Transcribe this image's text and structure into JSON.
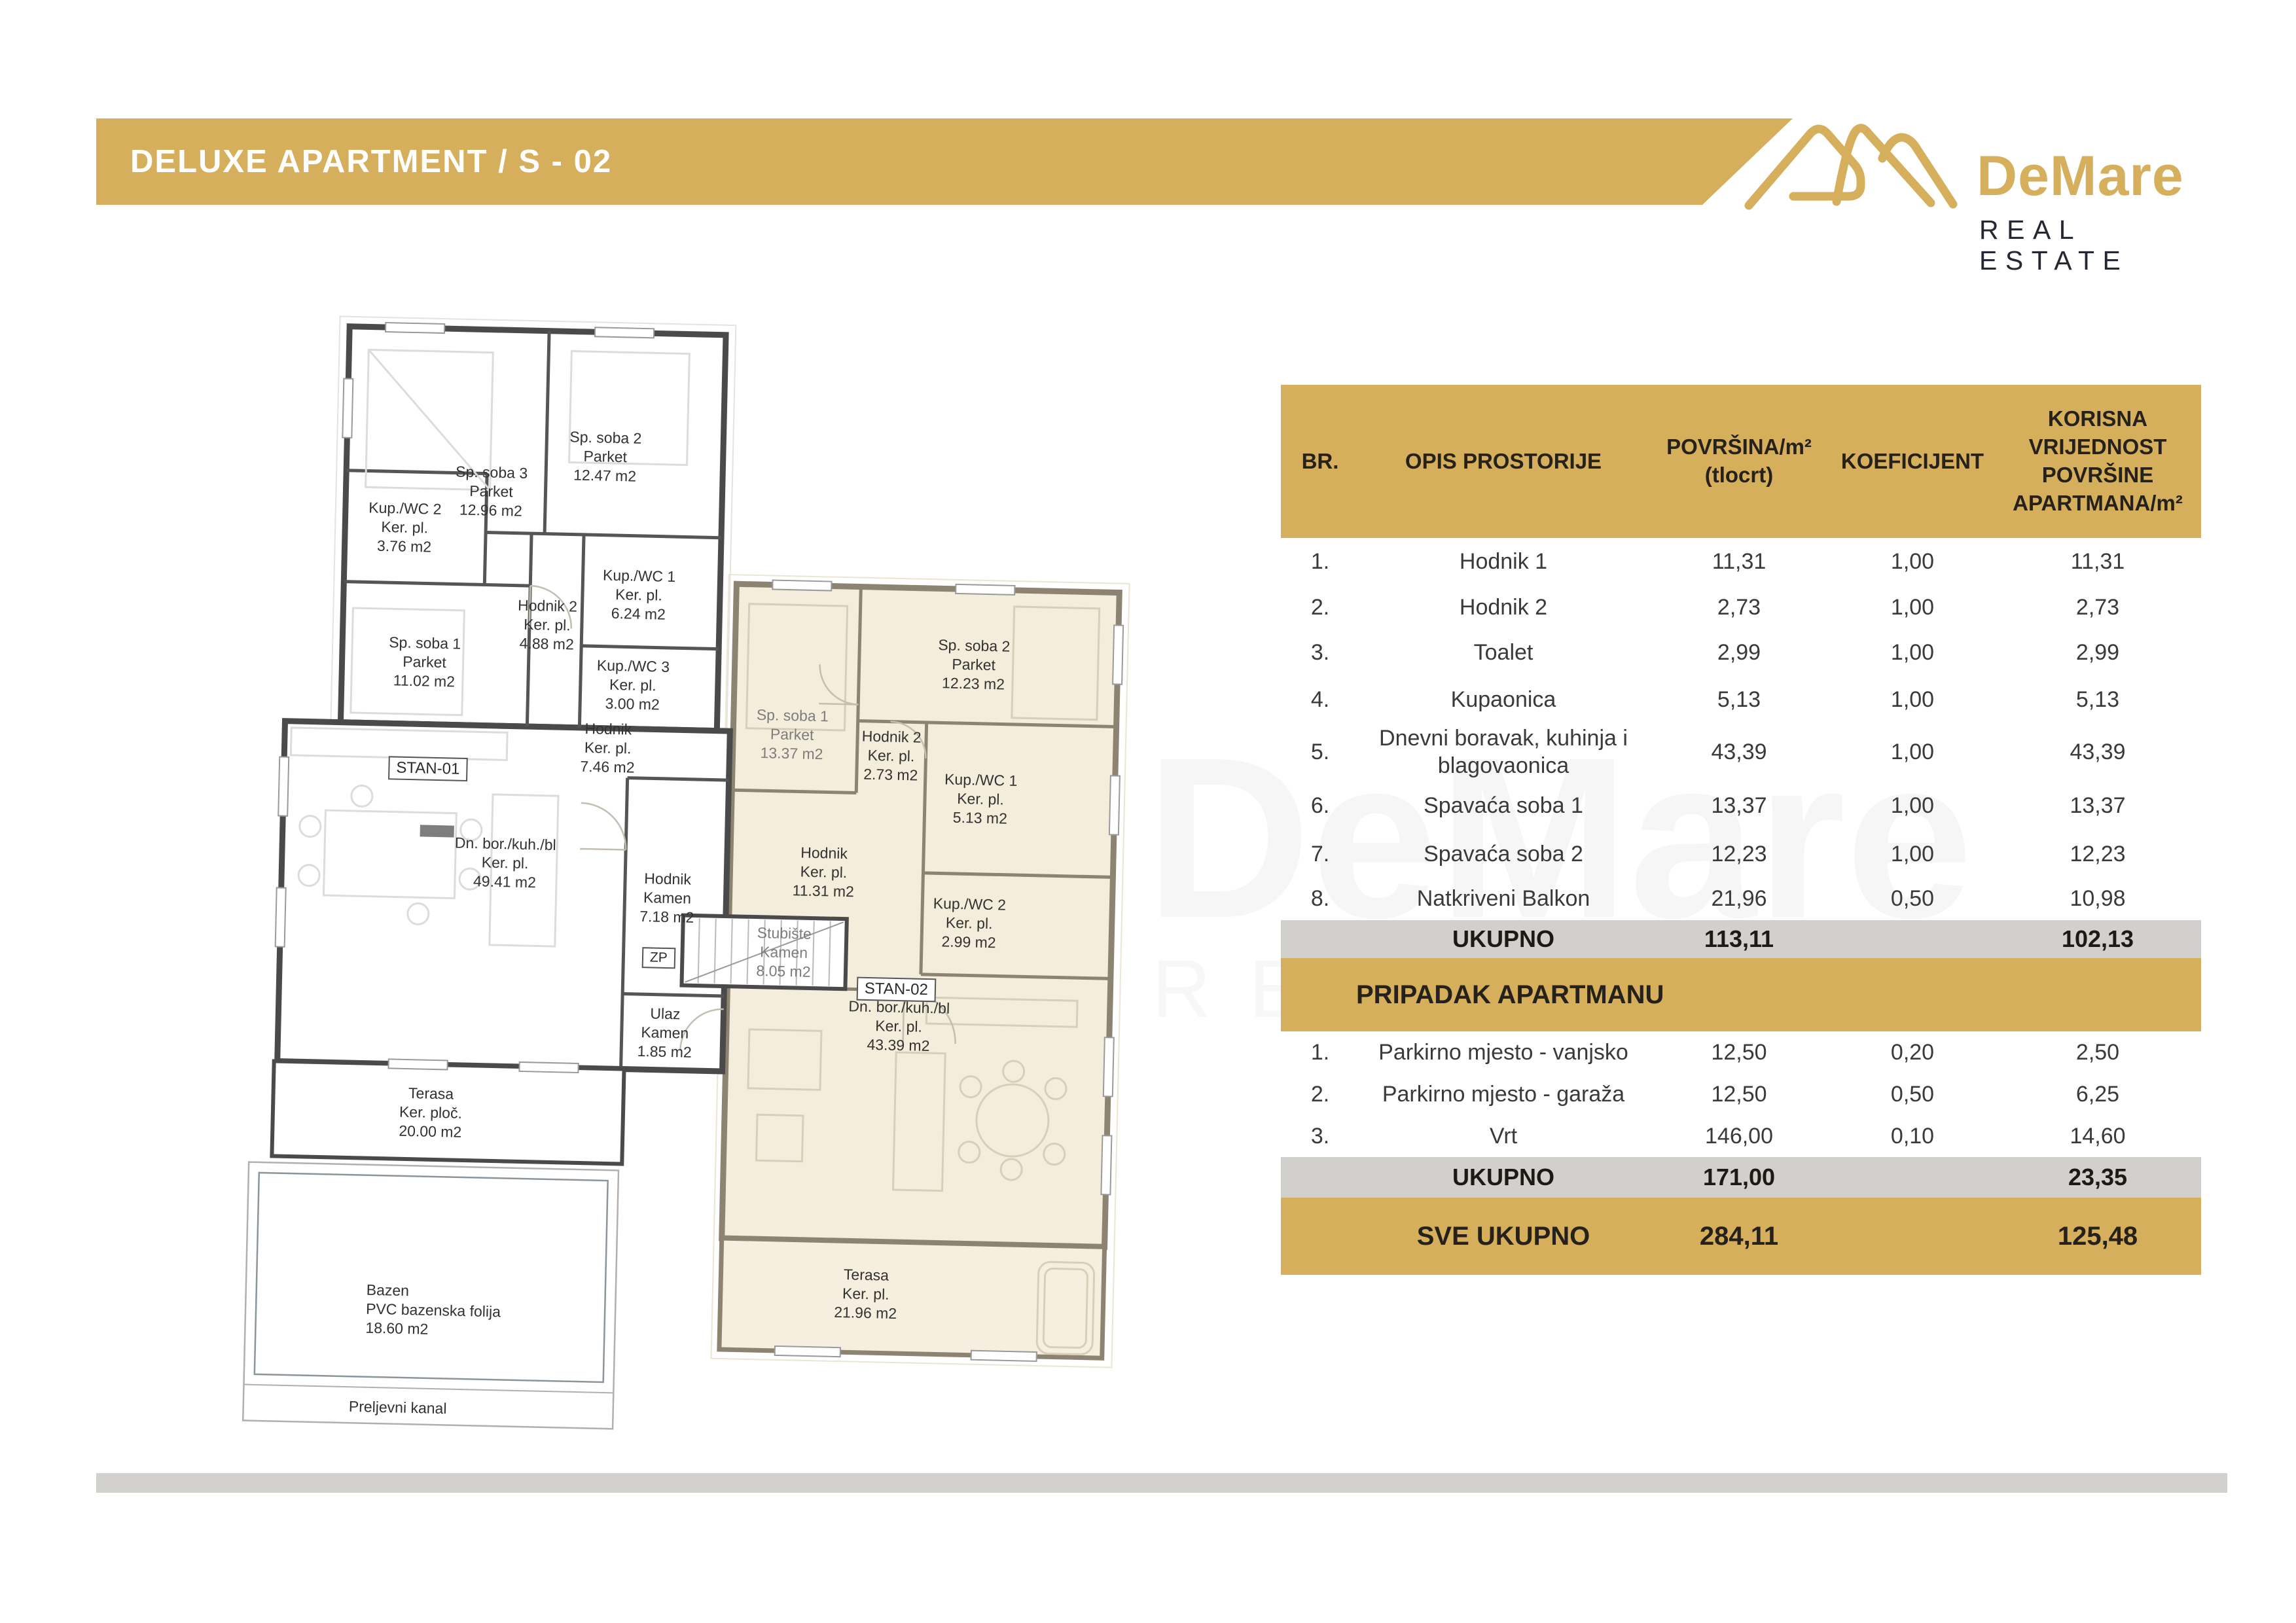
{
  "header": {
    "title": "DELUXE APARTMENT  / S - 02"
  },
  "logo": {
    "name": "DeMare",
    "subtitle": "REAL ESTATE",
    "gold": "#D5AF5C",
    "dark": "#232833"
  },
  "watermark": {
    "line1": "DeMare",
    "line2": "REAL ESTATE"
  },
  "table": {
    "headers": {
      "br": "BR.",
      "opis": "OPIS PROSTORIJE",
      "povrsina_1": "POVRŠINA/m²",
      "povrsina_2": "(tlocrt)",
      "koef": "KOEFICIJENT",
      "korisna": "KORISNA VRIJEDNOST POVRŠINE APARTMANA/m²"
    },
    "rooms": [
      {
        "br": "1.",
        "name": "Hodnik 1",
        "area": "11,31",
        "koef": "1,00",
        "value": "11,31"
      },
      {
        "br": "2.",
        "name": "Hodnik 2",
        "area": "2,73",
        "koef": "1,00",
        "value": "2,73"
      },
      {
        "br": "3.",
        "name": "Toalet",
        "area": "2,99",
        "koef": "1,00",
        "value": "2,99"
      },
      {
        "br": "4.",
        "name": "Kupaonica",
        "area": "5,13",
        "koef": "1,00",
        "value": "5,13"
      },
      {
        "br": "5.",
        "name": "Dnevni boravak, kuhinja i blagovaonica",
        "area": "43,39",
        "koef": "1,00",
        "value": "43,39"
      },
      {
        "br": "6.",
        "name": "Spavaća soba 1",
        "area": "13,37",
        "koef": "1,00",
        "value": "13,37"
      },
      {
        "br": "7.",
        "name": "Spavaća soba 2",
        "area": "12,23",
        "koef": "1,00",
        "value": "12,23"
      },
      {
        "br": "8.",
        "name": "Natkriveni Balkon",
        "area": "21,96",
        "koef": "0,50",
        "value": "10,98"
      }
    ],
    "ukupno1": {
      "label": "UKUPNO",
      "area": "113,11",
      "value": "102,13"
    },
    "section2": "PRIPADAK APARTMANU",
    "extras": [
      {
        "br": "1.",
        "name": "Parkirno mjesto - vanjsko",
        "area": "12,50",
        "koef": "0,20",
        "value": "2,50"
      },
      {
        "br": "2.",
        "name": "Parkirno mjesto - garaža",
        "area": "12,50",
        "koef": "0,50",
        "value": "6,25"
      },
      {
        "br": "3.",
        "name": "Vrt",
        "area": "146,00",
        "koef": "0,10",
        "value": "14,60"
      }
    ],
    "ukupno2": {
      "label": "UKUPNO",
      "area": "171,00",
      "value": "23,35"
    },
    "total": {
      "label": "SVE UKUPNO",
      "area": "284,11",
      "value": "125,48"
    }
  },
  "floorplan": {
    "labels": {
      "s01_soba3": [
        "Sp. soba 3",
        "Parket",
        "12.96 m2"
      ],
      "s01_soba2": [
        "Sp. soba 2",
        "Parket",
        "12.47 m2"
      ],
      "s01_kupwc2": [
        "Kup./WC 2",
        "Ker. pl.",
        "3.76 m2"
      ],
      "s01_soba1": [
        "Sp. soba 1",
        "Parket",
        "11.02 m2"
      ],
      "s01_hodnik2": [
        "Hodnik 2",
        "Ker. pl.",
        "4.88 m2"
      ],
      "s01_kupwc1": [
        "Kup./WC 1",
        "Ker. pl.",
        "6.24 m2"
      ],
      "s01_kupwc3": [
        "Kup./WC 3",
        "Ker. pl.",
        "3.00 m2"
      ],
      "s01_hodnik": [
        "Hodnik",
        "Ker. pl.",
        "7.46 m2"
      ],
      "s01_unit": "STAN-01",
      "s01_dnevni": [
        "Dn. bor./kuh./bl",
        "Ker. pl.",
        "49.41 m2"
      ],
      "s01_hodnik_kamen": [
        "Hodnik",
        "Kamen",
        "7.18 m2"
      ],
      "zp": "ZP",
      "s01_ulaz": [
        "Ulaz",
        "Kamen",
        "1.85 m2"
      ],
      "s01_terasa": [
        "Terasa",
        "Ker. ploč.",
        "20.00 m2"
      ],
      "bazen": [
        "Bazen",
        "PVC bazenska folija",
        "18.60 m2"
      ],
      "preljevni": "Preljevni kanal",
      "s02_soba1": [
        "Sp. soba 1",
        "Parket",
        "13.37 m2"
      ],
      "s02_soba2": [
        "Sp. soba 2",
        "Parket",
        "12.23 m2"
      ],
      "s02_hodnik2": [
        "Hodnik 2",
        "Ker. pl.",
        "2.73 m2"
      ],
      "s02_kupwc1": [
        "Kup./WC 1",
        "Ker. pl.",
        "5.13 m2"
      ],
      "s02_hodnik": [
        "Hodnik",
        "Ker. pl.",
        "11.31 m2"
      ],
      "s02_kupwc2": [
        "Kup./WC 2",
        "Ker. pl.",
        "2.99 m2"
      ],
      "stubiste": [
        "Stubište",
        "Kamen",
        "8.05 m2"
      ],
      "s02_unit": "STAN-02",
      "s02_dnevni": [
        "Dn. bor./kuh./bl",
        "Ker. pl.",
        "43.39 m2"
      ],
      "s02_terasa": [
        "Terasa",
        "Ker. pl.",
        "21.96 m2"
      ]
    },
    "colors": {
      "stan01_wall": "#4a4a4a",
      "stan02_wall": "#8d8371",
      "stan02_fill": "#f4eddb"
    }
  }
}
